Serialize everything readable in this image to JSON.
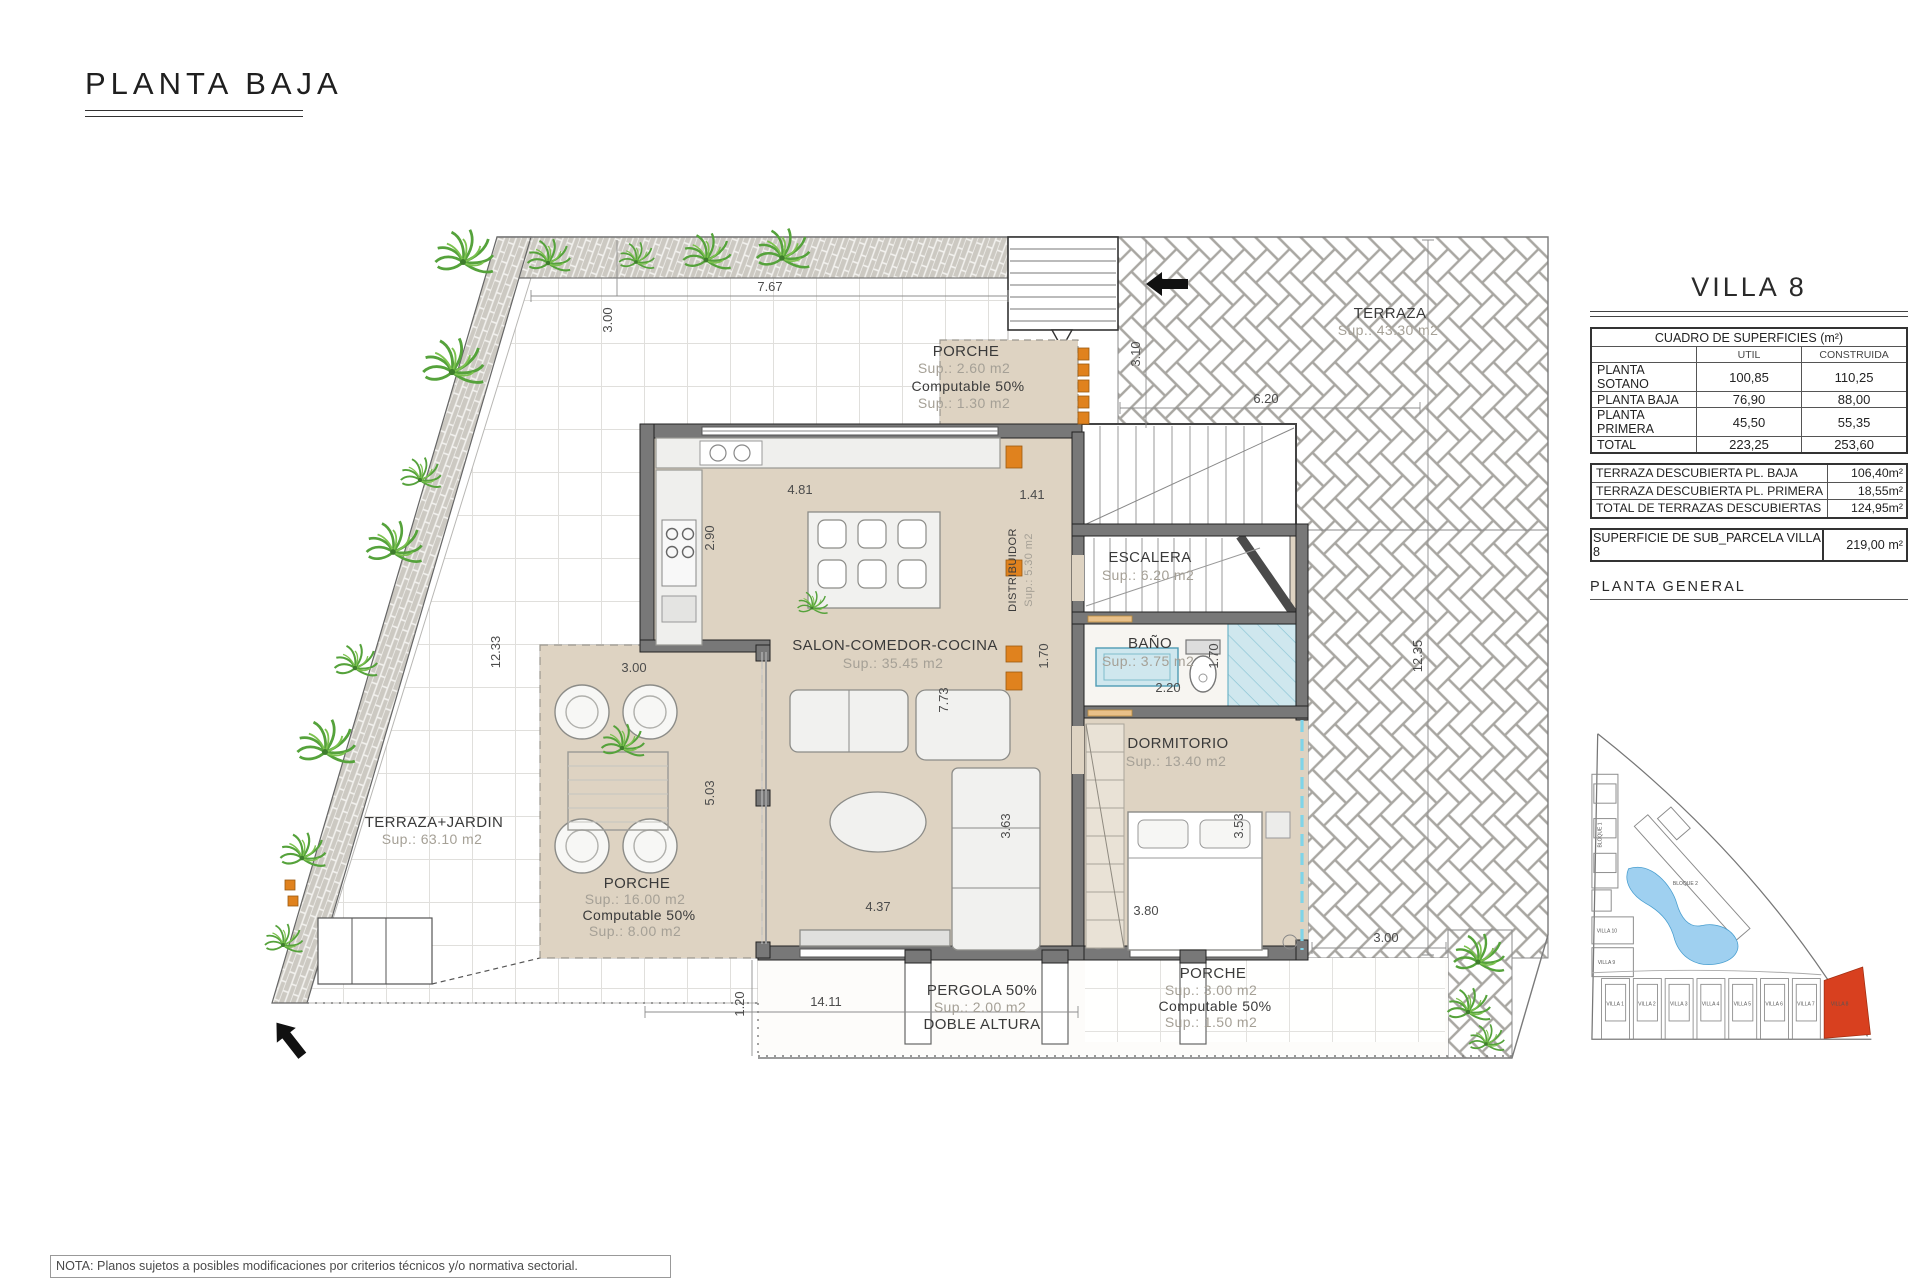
{
  "page": {
    "title": "PLANTA BAJA",
    "note": "NOTA: Planos sujetos a posibles modificaciones por criterios técnicos y/o normativa sectorial."
  },
  "colors": {
    "floor_beige": "#ded3c2",
    "wall_gray": "#787878",
    "accent_orange": "#e0821e",
    "villa8_highlight": "#d8401f",
    "tile_blue": "#cfe7ee",
    "plant_green": "#55a23b",
    "pool_blue": "#9fd0f0"
  },
  "panel": {
    "villa_title": "VILLA 8",
    "surfaces_table": {
      "title": "CUADRO DE SUPERFICIES (m²)",
      "col_util": "UTIL",
      "col_construida": "CONSTRUIDA",
      "rows": [
        {
          "label": "PLANTA SOTANO",
          "util": "100,85",
          "construida": "110,25"
        },
        {
          "label": "PLANTA BAJA",
          "util": "76,90",
          "construida": "88,00"
        },
        {
          "label": "PLANTA PRIMERA",
          "util": "45,50",
          "construida": "55,35"
        },
        {
          "label": "TOTAL",
          "util": "223,25",
          "construida": "253,60"
        }
      ]
    },
    "terraces_table": [
      {
        "label": "TERRAZA DESCUBIERTA PL. BAJA",
        "value": "106,40m²"
      },
      {
        "label": "TERRAZA DESCUBIERTA PL. PRIMERA",
        "value": "18,55m²"
      },
      {
        "label": "TOTAL DE TERRAZAS DESCUBIERTAS",
        "value": "124,95m²"
      }
    ],
    "parcel_row": {
      "label": "SUPERFICIE DE SUB_PARCELA VILLA 8",
      "value": "219,00 m²"
    },
    "site_plan_title": "PLANTA GENERAL",
    "site_plan": {
      "bloque1": "BLOQUE 1",
      "bloque2": "BLOQUE 2",
      "villa10": "VILLA 10",
      "villa9": "VILLA 9",
      "villas_row": [
        "VILLA 1",
        "VILLA 2",
        "VILLA 3",
        "VILLA 4",
        "VILLA 5",
        "VILLA 6",
        "VILLA 7",
        "VILLA 8"
      ]
    }
  },
  "plan": {
    "rooms": {
      "porche_top": [
        "PORCHE",
        "Sup.: 2.60 m2",
        "Computable 50%",
        "Sup.: 1.30 m2"
      ],
      "salon": [
        "SALON-COMEDOR-COCINA",
        "Sup.: 35.45 m2"
      ],
      "escalera": [
        "ESCALERA",
        "Sup.: 6.20 m2"
      ],
      "distribuidor": [
        "DISTRIBUIDOR",
        "Sup.: 5.30 m2"
      ],
      "bano": [
        "BAÑO",
        "Sup.: 3.75 m2"
      ],
      "dormitorio": [
        "DORMITORIO",
        "Sup.: 13.40 m2"
      ],
      "terraza": [
        "TERRAZA",
        "Sup.: 43.30 m2"
      ],
      "terraza_jardin": [
        "TERRAZA+JARDIN",
        "Sup.: 63.10 m2"
      ],
      "porche_oeste": [
        "PORCHE",
        "Sup.: 16.00 m2",
        "Computable 50%",
        "Sup.: 8.00 m2"
      ],
      "pergola": [
        "PERGOLA 50%",
        "Sup.: 2.00 m2",
        "DOBLE ALTURA"
      ],
      "porche_sur": [
        "PORCHE",
        "Sup.: 3.00 m2",
        "Computable 50%",
        "Sup.: 1.50 m2"
      ]
    },
    "dims": {
      "w_top": "7.67",
      "d_band": "3.00",
      "l_left": "12.33",
      "w_porch": "3.00",
      "w_kitchen": "4.81",
      "h_kitchen": "2.90",
      "w_hall": "1.41",
      "h_stair": "3.10",
      "w_terraza": "6.20",
      "l_right": "12.35",
      "h_bath_l": "1.70",
      "w_bath": "2.20",
      "h_bath_r": "1.70",
      "h_salon": "7.73",
      "h_porch": "5.03",
      "h_dorm_l": "3.63",
      "h_dorm_r": "3.53",
      "w_bed": "3.80",
      "w_salon": "4.37",
      "w_bottom": "14.11",
      "h_bottom": "1.20",
      "w_porche_sur": "3.00"
    }
  }
}
